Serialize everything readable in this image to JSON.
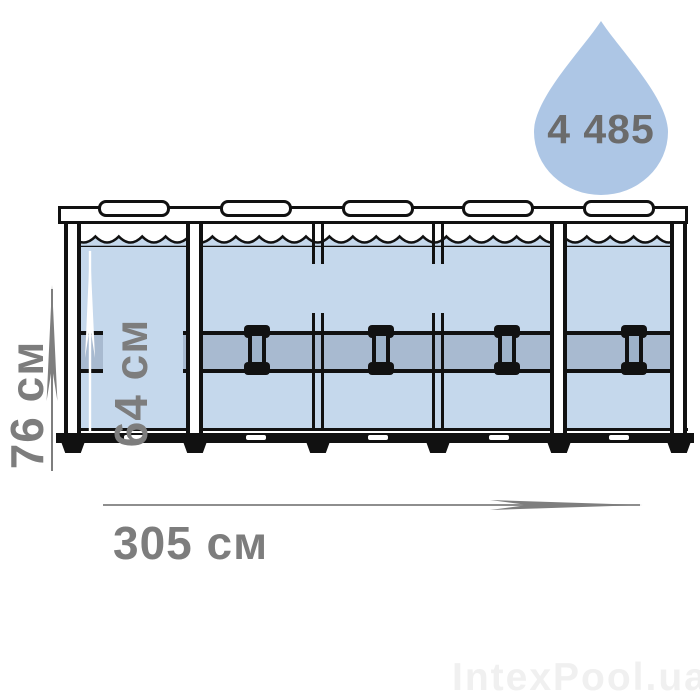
{
  "drop": {
    "volume": "4 485"
  },
  "dimensions": {
    "frame_height": "76 см",
    "water_height": "64 см",
    "length": "305 см"
  },
  "watermark": "IntexPool.ua",
  "colors": {
    "water": "#c5d8ec",
    "band": "#a8bad0",
    "drop": "#adc6e5",
    "label_gray": "#7d7d7d",
    "outline": "#111111"
  }
}
